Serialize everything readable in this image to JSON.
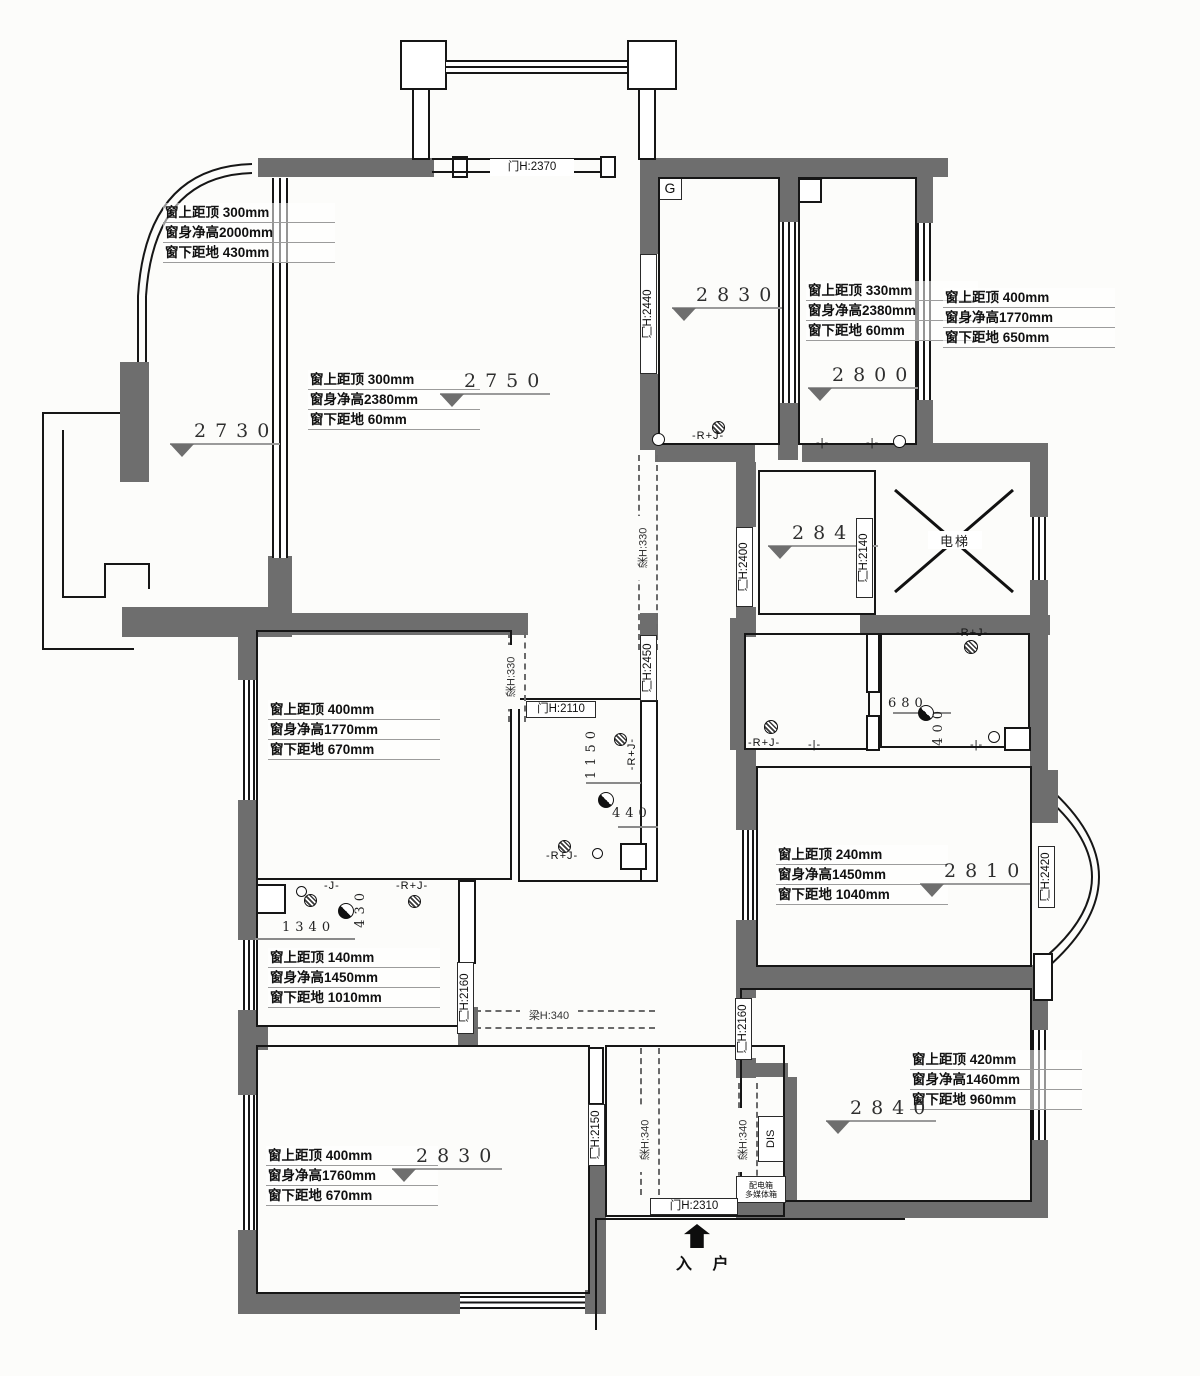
{
  "plan": {
    "specs": [
      {
        "id": "balcony-window",
        "x": 163,
        "y": 203,
        "lines": [
          "窗上距顶 300mm",
          "窗身净高2000mm",
          "窗下距地 430mm"
        ]
      },
      {
        "id": "living-window",
        "x": 308,
        "y": 370,
        "lines": [
          "窗上距顶 300mm",
          "窗身净高2380mm",
          "窗下距地 60mm"
        ]
      },
      {
        "id": "room2800-window",
        "x": 806,
        "y": 281,
        "lines": [
          "窗上距顶 330mm",
          "窗身净高2380mm",
          "窗下距地 60mm"
        ]
      },
      {
        "id": "east-outer-window",
        "x": 943,
        "y": 288,
        "lines": [
          "窗上距顶 400mm",
          "窗身净高1770mm",
          "窗下距地 650mm"
        ]
      },
      {
        "id": "midleft-window",
        "x": 268,
        "y": 700,
        "lines": [
          "窗上距顶 400mm",
          "窗身净高1770mm",
          "窗下距地 670mm"
        ]
      },
      {
        "id": "bath-window",
        "x": 268,
        "y": 948,
        "lines": [
          "窗上距顶 140mm",
          "窗身净高1450mm",
          "窗下距地 1010mm"
        ]
      },
      {
        "id": "bedroomL-window",
        "x": 266,
        "y": 1146,
        "lines": [
          "窗上距顶 400mm",
          "窗身净高1760mm",
          "窗下距地 670mm"
        ]
      },
      {
        "id": "room2810-window",
        "x": 776,
        "y": 845,
        "lines": [
          "窗上距顶 240mm",
          "窗身净高1450mm",
          "窗下距地 1040mm"
        ]
      },
      {
        "id": "bedroomN-window",
        "x": 910,
        "y": 1050,
        "lines": [
          "窗上距顶 420mm",
          "窗身净高1460mm",
          "窗下距地 960mm"
        ]
      }
    ],
    "levels": [
      {
        "value": "2730",
        "x": 170,
        "y": 420
      },
      {
        "value": "2750",
        "x": 440,
        "y": 370
      },
      {
        "value": "2830",
        "x": 672,
        "y": 284
      },
      {
        "value": "2800",
        "x": 808,
        "y": 364
      },
      {
        "value": "2840",
        "x": 768,
        "y": 522
      },
      {
        "value": "2810",
        "x": 920,
        "y": 860
      },
      {
        "value": "2830",
        "x": 392,
        "y": 1145
      },
      {
        "value": "2840",
        "x": 826,
        "y": 1097
      }
    ],
    "doors": [
      {
        "label": "门H:2370",
        "orient": "h",
        "x": 490,
        "y": 159,
        "len": 84,
        "boxed": false
      },
      {
        "label": "门H:2440",
        "orient": "v",
        "x": 640,
        "y": 254,
        "len": 120,
        "boxed": true
      },
      {
        "label": "门H:2400",
        "orient": "v",
        "x": 736,
        "y": 527,
        "len": 80,
        "boxed": true
      },
      {
        "label": "门H:2140",
        "orient": "v",
        "x": 856,
        "y": 518,
        "len": 80,
        "boxed": true
      },
      {
        "label": "门H:2450",
        "orient": "v",
        "x": 640,
        "y": 635,
        "len": 66,
        "boxed": true
      },
      {
        "label": "门H:2110",
        "orient": "h",
        "x": 526,
        "y": 701,
        "len": 70,
        "boxed": true
      },
      {
        "label": "门H:2160",
        "orient": "v",
        "x": 457,
        "y": 962,
        "len": 72,
        "boxed": true
      },
      {
        "label": "门H:2420",
        "orient": "v",
        "x": 1038,
        "y": 846,
        "len": 62,
        "boxed": true
      },
      {
        "label": "门H:2160",
        "orient": "v",
        "x": 735,
        "y": 998,
        "len": 62,
        "boxed": true
      },
      {
        "label": "门H:2150",
        "orient": "v",
        "x": 588,
        "y": 1104,
        "len": 62,
        "boxed": true
      },
      {
        "label": "门H:2310",
        "orient": "h",
        "x": 650,
        "y": 1198,
        "len": 88,
        "boxed": true
      }
    ],
    "beams": [
      {
        "label": "梁H:330",
        "orient": "v",
        "x": 636,
        "y": 516,
        "len": 64
      },
      {
        "label": "梁H:330",
        "orient": "v",
        "x": 504,
        "y": 645,
        "len": 64
      },
      {
        "label": "梁H:340",
        "orient": "h",
        "x": 520,
        "y": 1009,
        "len": 58
      },
      {
        "label": "梁H:340",
        "orient": "v",
        "x": 638,
        "y": 1108,
        "len": 64
      },
      {
        "label": "梁H:340",
        "orient": "v",
        "x": 736,
        "y": 1108,
        "len": 64
      }
    ],
    "dims": [
      {
        "value": "1150",
        "orient": "v",
        "x": 584,
        "y": 726
      },
      {
        "value": "440",
        "orient": "h",
        "x": 612,
        "y": 806
      },
      {
        "value": "1340",
        "orient": "h",
        "x": 282,
        "y": 920
      },
      {
        "value": "430",
        "orient": "v",
        "x": 353,
        "y": 888
      },
      {
        "value": "680",
        "orient": "h",
        "x": 888,
        "y": 696
      },
      {
        "value": "400",
        "orient": "v",
        "x": 931,
        "y": 706
      }
    ],
    "elec": [
      {
        "text": "-R+J-",
        "x": 692,
        "y": 430
      },
      {
        "text": "-|-",
        "x": 866,
        "y": 437
      },
      {
        "text": "-R+J-",
        "x": 956,
        "y": 627
      },
      {
        "text": "-R+J-",
        "x": 748,
        "y": 737
      },
      {
        "text": "-|-",
        "x": 808,
        "y": 739
      },
      {
        "text": "-|-",
        "x": 970,
        "y": 739
      },
      {
        "text": "-R+J-",
        "x": 626,
        "y": 738,
        "orient": "v"
      },
      {
        "text": "-R+J-",
        "x": 546,
        "y": 850
      },
      {
        "text": "-J-",
        "x": 324,
        "y": 880
      },
      {
        "text": "-R+J-",
        "x": 396,
        "y": 880
      },
      {
        "text": "-|-",
        "x": 816,
        "y": 437
      }
    ],
    "tags": {
      "g": "G",
      "elevator": "电梯",
      "dis": "DIS",
      "panel1": "配电箱",
      "panel2": "多媒体箱",
      "entry": "入 户"
    }
  },
  "colors": {
    "wall": "#6e6e6e",
    "line": "#161616",
    "background": "#fcfcfa"
  }
}
